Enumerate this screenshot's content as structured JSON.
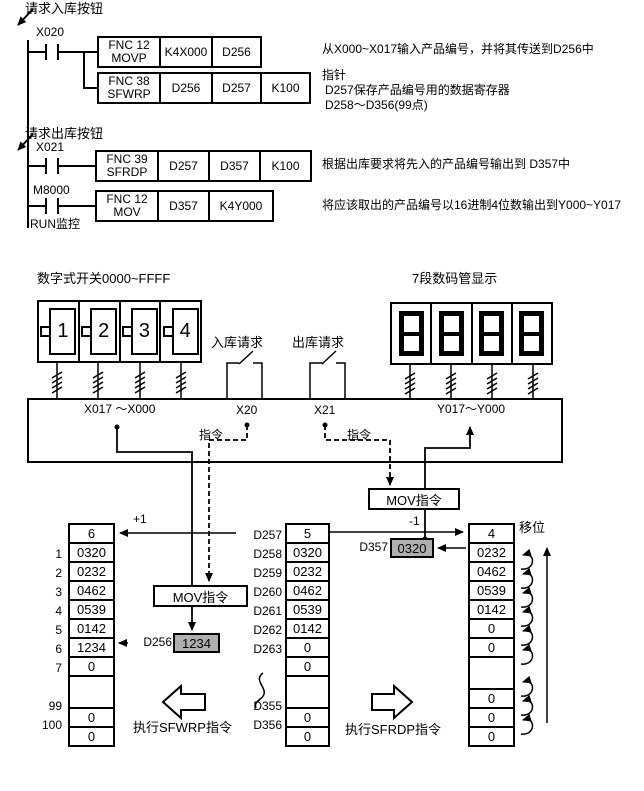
{
  "ladder": {
    "comment_in": "请求入库按钮",
    "comment_out": "请求出库按钮",
    "contact1": "X020",
    "contact2": "X021",
    "contact3": "M8000",
    "run_label": "RUN监控",
    "row1": {
      "fnc": "FNC 12",
      "mn": "MOVP",
      "op1": "K4X000",
      "op2": "D256"
    },
    "row2": {
      "fnc": "FNC 38",
      "mn": "SFWRP",
      "op1": "D256",
      "op2": "D257",
      "op3": "K100"
    },
    "row3": {
      "fnc": "FNC 39",
      "mn": "SFRDP",
      "op1": "D257",
      "op2": "D357",
      "op3": "K100"
    },
    "row4": {
      "fnc": "FNC 12",
      "mn": "MOV",
      "op1": "D357",
      "op2": "K4Y000"
    },
    "note1": "从X000~X017输入产品编号，并将其传送到D256中",
    "note2a": "指针",
    "note2b": "D257保存产品编号用的数据寄存器",
    "note2c": "D258～D356(99点)",
    "note3": "根据出库要求将先入的产品编号输出到 D357中",
    "note4": "将应该取出的产品编号以16进制4位数输出到Y000~Y017"
  },
  "panel": {
    "switch_label": "数字式开关0000~FFFF",
    "digit1": "1",
    "digit2": "2",
    "digit3": "3",
    "digit4": "4",
    "in_request": "入库请求",
    "out_request": "出库请求",
    "seg_label": "7段数码管显示",
    "seg_value": "8888",
    "x_range": "X017 ～X000",
    "x20": "X20",
    "x21": "X21",
    "y_range": "Y017～Y000",
    "cmd_left": "指令",
    "cmd_right": "指令",
    "mov_left": "MOV指令",
    "mov_right": "MOV指令"
  },
  "flow": {
    "plus_one": "+1",
    "minus_one": "-1",
    "shift_label": "移位",
    "d256_label": "D256",
    "d256_value": "1234",
    "d357_label": "D357",
    "d357_value": "0320",
    "exec_left": "执行SFWRP指令",
    "exec_right": "执行SFRDP指令"
  },
  "tables": {
    "left": {
      "header": "6",
      "rows": [
        {
          "n": "1",
          "v": "0320"
        },
        {
          "n": "2",
          "v": "0232"
        },
        {
          "n": "3",
          "v": "0462"
        },
        {
          "n": "4",
          "v": "0539"
        },
        {
          "n": "5",
          "v": "0142"
        },
        {
          "n": "6",
          "v": "1234"
        },
        {
          "n": "7",
          "v": "0"
        }
      ],
      "tail": [
        {
          "n": "99",
          "v": "0"
        },
        {
          "n": "100",
          "v": "0"
        }
      ]
    },
    "middle": {
      "head": {
        "n": "D257",
        "v": "5"
      },
      "rows": [
        {
          "n": "D258",
          "v": "0320"
        },
        {
          "n": "D259",
          "v": "0232"
        },
        {
          "n": "D260",
          "v": "0462"
        },
        {
          "n": "D261",
          "v": "0539"
        },
        {
          "n": "D262",
          "v": "0142"
        },
        {
          "n": "D263",
          "v": "0"
        },
        {
          "n": "",
          "v": "0"
        }
      ],
      "tail": [
        {
          "n": "D355",
          "v": "0"
        },
        {
          "n": "D356",
          "v": "0"
        }
      ]
    },
    "right": {
      "header": "4",
      "rows": [
        "0232",
        "0462",
        "0539",
        "0142",
        "0",
        "0"
      ],
      "tail": [
        "0",
        "0",
        "0"
      ]
    }
  },
  "colors": {
    "gray": "#b0b0b0"
  }
}
